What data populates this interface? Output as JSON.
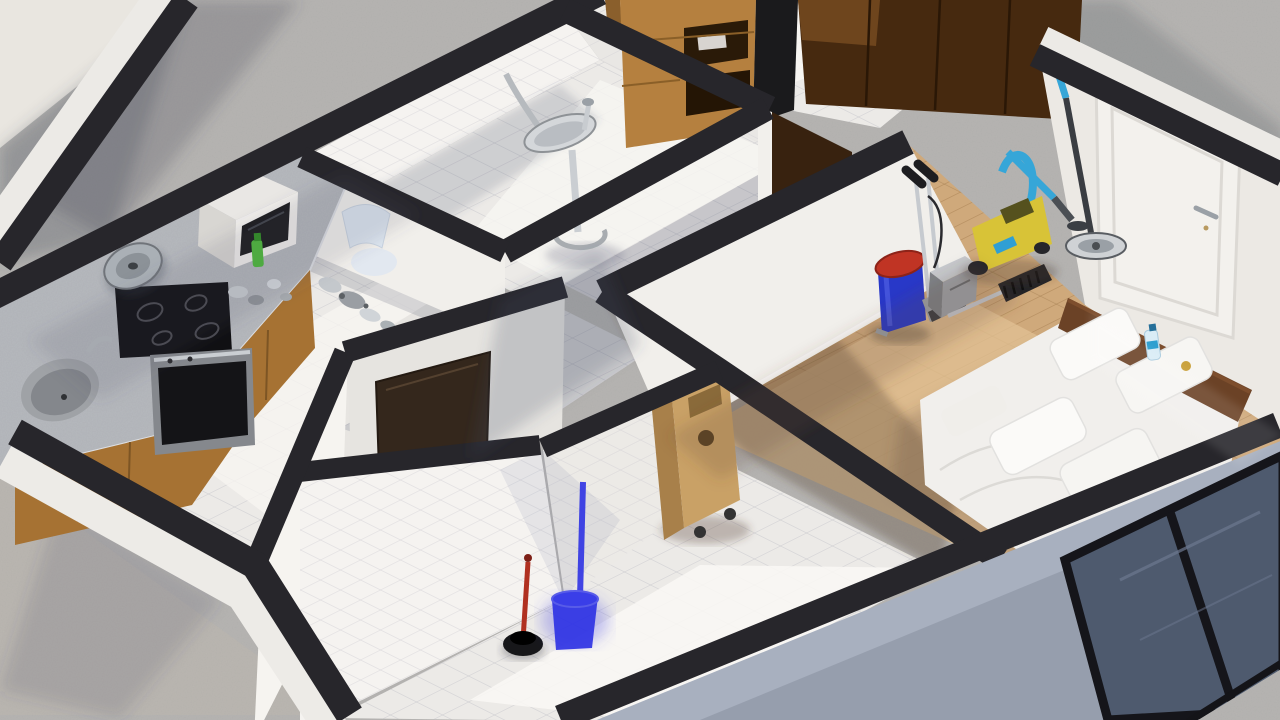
{
  "scene": {
    "title": "Isometric cutaway 3D render of a furnished apartment",
    "view": "top-down dollhouse view, no HUD or text overlays",
    "rooms": [
      {
        "name": "kitchen",
        "floor": "white tile",
        "objects": [
          "speckled counter",
          "induction cooktop",
          "oven",
          "microwave oven",
          "large pot lid",
          "round sink basin",
          "green dish soap bottle",
          "chrome faucet parts on floor",
          "white chair"
        ]
      },
      {
        "name": "bathroom-upper",
        "floor": "white tile",
        "walls": "white tile",
        "objects": [
          "chrome pedestal sink",
          "black scrub brush"
        ]
      },
      {
        "name": "hallway",
        "floor": "white tile",
        "objects": [
          "light wood cabinet",
          "dark wood wardrobe"
        ]
      },
      {
        "name": "vestibule",
        "floor": "white tile",
        "objects": [
          "dark brown entry door"
        ]
      },
      {
        "name": "bathroom-lower",
        "floor": "white tile",
        "walls": "white tile",
        "objects": [
          "red plunger",
          "glowing blue bucket with brush"
        ]
      },
      {
        "name": "bedroom",
        "floor": "light wood planks",
        "objects": [
          "white interior door",
          "blue stick vacuum",
          "yellow canister vacuum with blue hose",
          "chrome carpet sweeper",
          "blue pedal bin with red lid",
          "steel box",
          "floor brush",
          "wooden service cart",
          "double bed with white bedding",
          "wood headboard shelf",
          "water bottle",
          "wooden desk",
          "spray bottle",
          "red box",
          "cutting board",
          "black framed window"
        ]
      }
    ]
  },
  "palette": {
    "concrete": "#b7b5b2",
    "concreteLit": "#e9e6e0",
    "whiteBand": "#edebe7",
    "wallTop": "#27262b",
    "wallFaceLit": "#f1efeb",
    "wallFaceShade": "#e6e4e0",
    "tileFloor": "#eceae7",
    "tileWall": "#f5f3f0",
    "woodFloor": "#cfa97b",
    "woodCabinet": "#a67233",
    "cabinetLight": "#b5803f",
    "darkWood": "#46290f",
    "darkWoodSide": "#38220f",
    "counterTop": "#b6b9be",
    "applianceBlack": "#101013",
    "ovenBlack": "#141417",
    "steel": "#9aa0a6",
    "chrome": "#c6cacf",
    "microwaveWhite": "#e9e7e4",
    "bedWhite": "#f1efec",
    "pillowWhite": "#fbfaf8",
    "doorWhite": "#f3f1ed",
    "entryDoor": "#34271c",
    "headboard": "#6b4226",
    "binBlue": "#2838c8",
    "binLidRed": "#c03424",
    "bucketBlue": "#2f33e4",
    "plungerRed": "#b03020",
    "vacuumYellow": "#d8c337",
    "hoseBlue": "#36a6d8",
    "sweeperChrome": "#c6cacf",
    "glassBlue": "#4e5a6e",
    "exteriorShade": "#a8b0bf",
    "chairBlue": "#e2e8f0",
    "cartWood": "#c9a166",
    "deskWood": "#b9894f",
    "redBox": "#c23828",
    "sprayTeal": "#3bb8c8",
    "bottleBlue": "#2f9fd0",
    "sodaGreen": "#4db83a"
  }
}
